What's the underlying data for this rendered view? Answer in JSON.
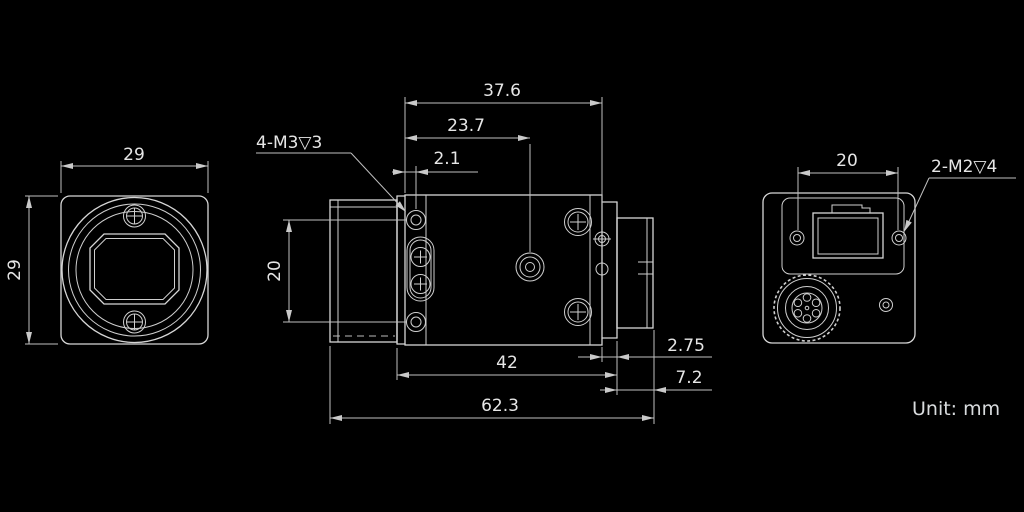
{
  "front_view": {
    "width": "29",
    "height": "29"
  },
  "side_view": {
    "housing_length": "37.6",
    "hole_span": "23.7",
    "front_hole_offset": "2.1",
    "thread_note": "4-M3▽3",
    "hole_pitch": "20",
    "body_length": "42",
    "rear_step": "2.75",
    "rear_block": "7.2",
    "overall_length": "62.3"
  },
  "rear_view": {
    "screw_pitch": "20",
    "thread_note": "2-M2▽4"
  },
  "footer": {
    "unit_note": "Unit: mm"
  },
  "colors": {
    "background": "#000000",
    "line": "#d6d6d6",
    "text": "#e6e6e6"
  }
}
